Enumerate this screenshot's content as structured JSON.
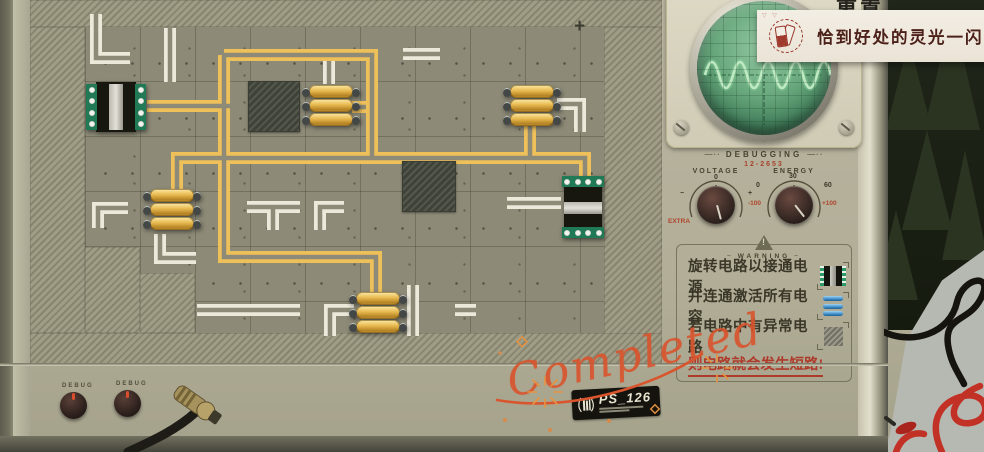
{
  "notification": {
    "marks": "▽ ▽",
    "text": "恰到好处的灵光一闪",
    "icon": "inspiration-cards-icon"
  },
  "top_partial_button": {
    "text": "重置"
  },
  "board": {
    "crosshair": "+",
    "traces": {
      "white": [
        "M 96 14 V 58 H 130",
        "M 170 28 V 82",
        "M 403 54 H 440",
        "M 329 58 V 84",
        "M 247 207 H 300",
        "M 273 207 V 230",
        "M 320 230 V 207 H 344",
        "M 98 228 V 208 H 128",
        "M 160 234 V 258 H 196",
        "M 197 310 H 300",
        "M 330 336 V 310 H 354",
        "M 413 285 V 336",
        "M 455 310 H 476",
        "M 507 203 H 561",
        "M 557 104 H 580 V 132"
      ],
      "yellow": [
        "M 147 106 H 230",
        "M 224 55 V 257 H 376 V 293",
        "M 224 55 H 372 V 158",
        "M 352 107 H 366",
        "M 177 196 V 158 H 585 V 180",
        "M 530 122 V 160"
      ]
    },
    "hatched": [
      [
        30,
        0,
        632,
        27
      ],
      [
        30,
        27,
        55,
        306
      ],
      [
        604,
        27,
        58,
        309
      ],
      [
        30,
        333,
        632,
        32
      ],
      [
        85,
        247,
        55,
        86
      ],
      [
        140,
        273,
        55,
        60
      ]
    ],
    "obstacles": [
      [
        248,
        81,
        52,
        51
      ],
      [
        402,
        161,
        54,
        51
      ]
    ],
    "capacitors": [
      [
        303,
        84
      ],
      [
        504,
        84
      ],
      [
        144,
        188
      ],
      [
        350,
        291
      ]
    ],
    "chips": [
      {
        "x": 86,
        "y": 80,
        "o": "h"
      },
      {
        "x": 560,
        "y": 176,
        "o": "v"
      }
    ]
  },
  "debugging": {
    "title": "DEBUGGING",
    "serial": "12-2653",
    "voltage": {
      "label": "VOLTAGE",
      "tick_left": "−",
      "tick_top": "0",
      "tick_right": "+",
      "extra": "EXTRA"
    },
    "energy": {
      "label": "ENERGY",
      "tick_left": "0",
      "tick_top": "30",
      "tick_right": "60",
      "min": "-100",
      "max": "+100"
    }
  },
  "warning": {
    "title": "WARNING",
    "rules": [
      {
        "text": "旋转电路以接通电源",
        "icon": "chip-icon"
      },
      {
        "text": "并连通激活所有电容",
        "icon": "capacitor-icon"
      },
      {
        "text": "若电路中有异常电路",
        "icon": "anomaly-tile-icon"
      }
    ],
    "consequence": "则电路就会发生短路!"
  },
  "stamp": {
    "text": "Completed"
  },
  "nameplate": {
    "model": "PS_126"
  },
  "debug_knobs": {
    "left_label": "DEBUG",
    "right_label": "DEBUG"
  }
}
